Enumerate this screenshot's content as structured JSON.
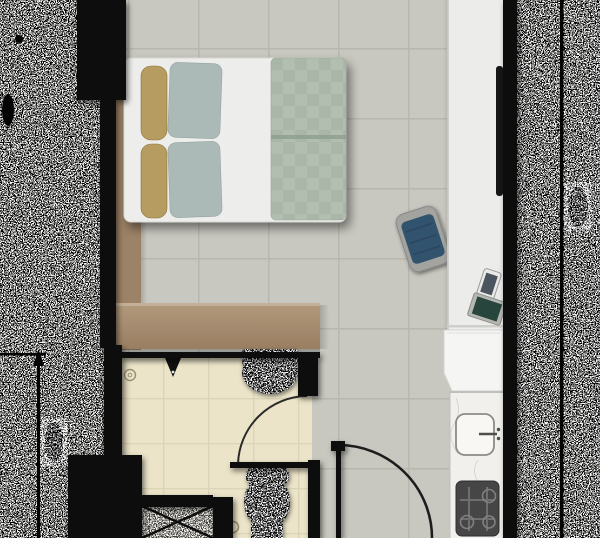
{
  "meta": {
    "title": "studio-apartment-floor-plan",
    "view": "top-down architectural plan",
    "width_px": 600,
    "height_px": 538
  },
  "rooms": {
    "main_room": {
      "label": "main living / sleeping area"
    },
    "bathroom": {
      "label": "bathroom"
    },
    "kitchenette": {
      "label": "kitchenette"
    },
    "entrance": {
      "label": "entrance"
    }
  },
  "furniture": {
    "bed": {
      "label": "double bed",
      "pillow_count": 4
    },
    "wardrobe": {
      "label": "L-shaped wardrobe partition"
    },
    "desk_chair": {
      "label": "desk chair"
    },
    "media_counter": {
      "label": "side counter / desk"
    },
    "tv": {
      "label": "television on counter"
    },
    "smartphone": {
      "label": "smartphone on desk"
    },
    "tablet": {
      "label": "tablet on desk"
    },
    "refrigerator": {
      "label": "tall cabinet / refrigerator"
    }
  },
  "fixtures": {
    "kitchen_sink": {
      "label": "kitchen sink with faucet"
    },
    "stove": {
      "label": "hob",
      "burner_count": 4
    },
    "bathroom_sink": {
      "label": "washbasin"
    },
    "toilet": {
      "label": "toilet"
    },
    "shower_tray": {
      "label": "shower tray with X mark"
    },
    "shower_head": {
      "label": "shower head"
    },
    "floor_drain": {
      "label": "floor drain"
    },
    "bathroom_door": {
      "label": "bathroom door with 90-degree swing arc"
    },
    "entrance_door": {
      "label": "entrance door with 90-degree swing arc"
    }
  },
  "annotations": {
    "left_dimension": {
      "type": "vertical dimension line with up arrow",
      "legible": false
    },
    "right_dimension": {
      "type": "vertical dimension line",
      "legible": false
    },
    "noise": {
      "left_strip": true,
      "right_strip": true,
      "description": "edge regions corrupted by black/white pixel noise"
    }
  },
  "colors": {
    "wall": "#070707",
    "floor_main": "#c9c8c0",
    "grout_main": "#b9b8ae",
    "floor_bath": "#ebe4c9",
    "grout_bath": "#dcd4b6",
    "wardrobe": "#a5896b",
    "wardrobe_dark": "#9c8266",
    "bed_base": "#ededec",
    "pillow_khaki": "#b69c60",
    "pillow_sage": "#abbab6",
    "duvet": "#b2bfb0",
    "duvet_check": "#aab7a8",
    "chair_seat": "#33536e",
    "chair_frame": "#a3a3a0",
    "counter": "#ececea",
    "fridge": "#f5f5f4",
    "marble": "#f2f0ed",
    "stove": "#464646",
    "tv": "#161616",
    "tray": "#f6f4ec",
    "noise_bg": "#f3f3f1"
  }
}
